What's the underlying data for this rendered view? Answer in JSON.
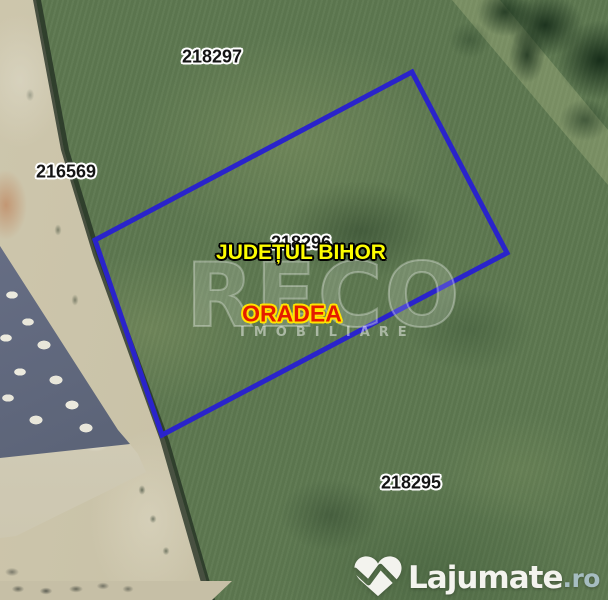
{
  "map": {
    "parcel_labels": [
      {
        "text": "218297"
      },
      {
        "text": "216569"
      },
      {
        "text": "218296"
      },
      {
        "text": "218295"
      }
    ],
    "region": {
      "county": "JUDEȚUL BIHOR",
      "city": "ORADEA"
    },
    "watermark": {
      "agency": "RECO",
      "tagline": "IMOBILIARE"
    },
    "logo": {
      "brand": "Lajumate",
      "tld": ".ro",
      "icon": "lajumate-heart-icon"
    },
    "colors": {
      "parcel_outline": "#2a23cb",
      "county_text": "#fdfd00",
      "city_text": "#e41b00",
      "parcel_label_text": "#141414",
      "logo_text": "#f3f3ee",
      "logo_tld": "#a6bdc1"
    }
  }
}
